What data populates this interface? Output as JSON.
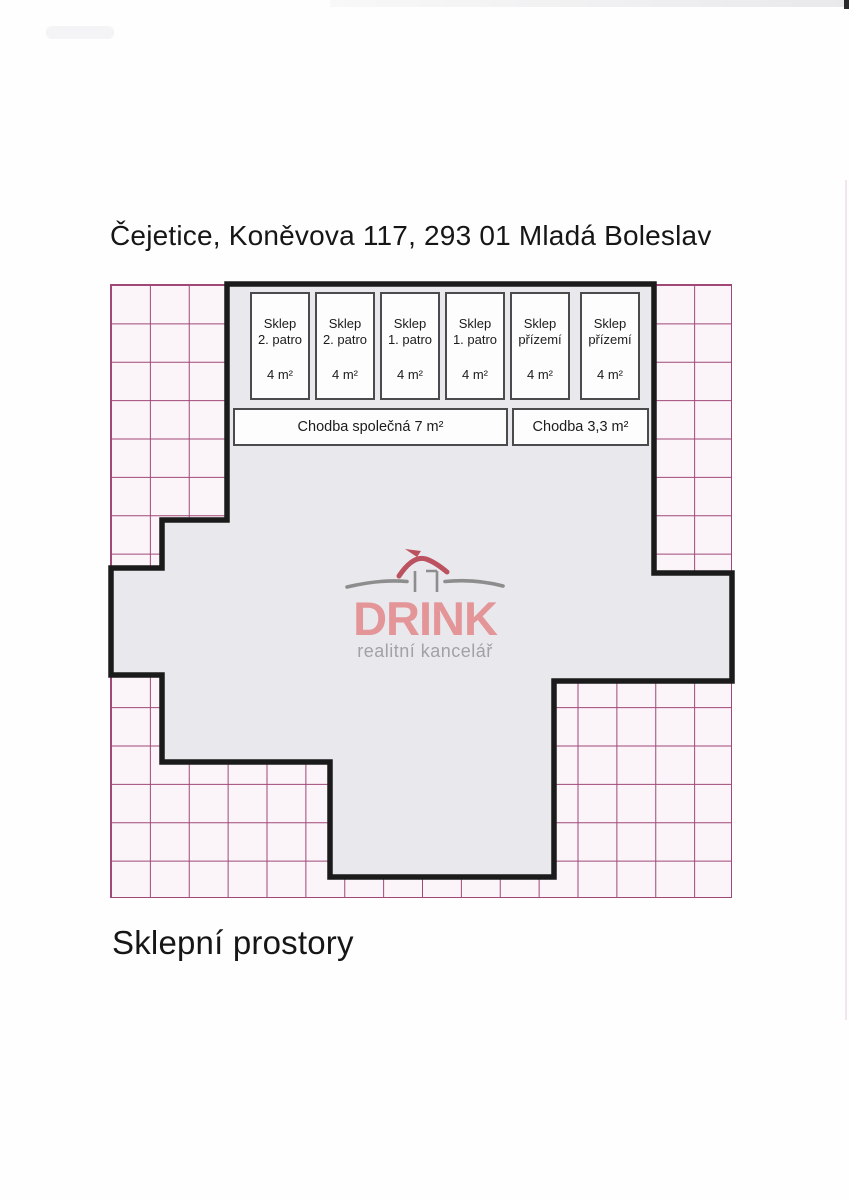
{
  "page": {
    "title": "Čejetice, Koněvova 117, 293 01 Mladá Boleslav",
    "caption": "Sklepní prostory"
  },
  "plan": {
    "rooms": [
      {
        "name": "Sklep",
        "floor": "2. patro",
        "area": "4 m²"
      },
      {
        "name": "Sklep",
        "floor": "2. patro",
        "area": "4 m²"
      },
      {
        "name": "Sklep",
        "floor": "1. patro",
        "area": "4 m²"
      },
      {
        "name": "Sklep",
        "floor": "1. patro",
        "area": "4 m²"
      },
      {
        "name": "Sklep",
        "floor": "přízemí",
        "area": "4 m²"
      },
      {
        "name": "Sklep",
        "floor": "přízemí",
        "area": "4 m²"
      }
    ],
    "corridors": [
      {
        "label": "Chodba společná 7 m²"
      },
      {
        "label": "Chodba 3,3 m²"
      }
    ]
  },
  "logo": {
    "name": "DRINK",
    "subtitle": "realitní kancelář"
  },
  "colors": {
    "grid_line": "#a04878",
    "grid_background": "#fbf4f9",
    "plan_fill": "#e8e8ed",
    "plan_outline": "#1b1b1b",
    "logo_text": "#e39598",
    "logo_roof": "#bc515f",
    "logo_gray": "#8d8d8d"
  }
}
